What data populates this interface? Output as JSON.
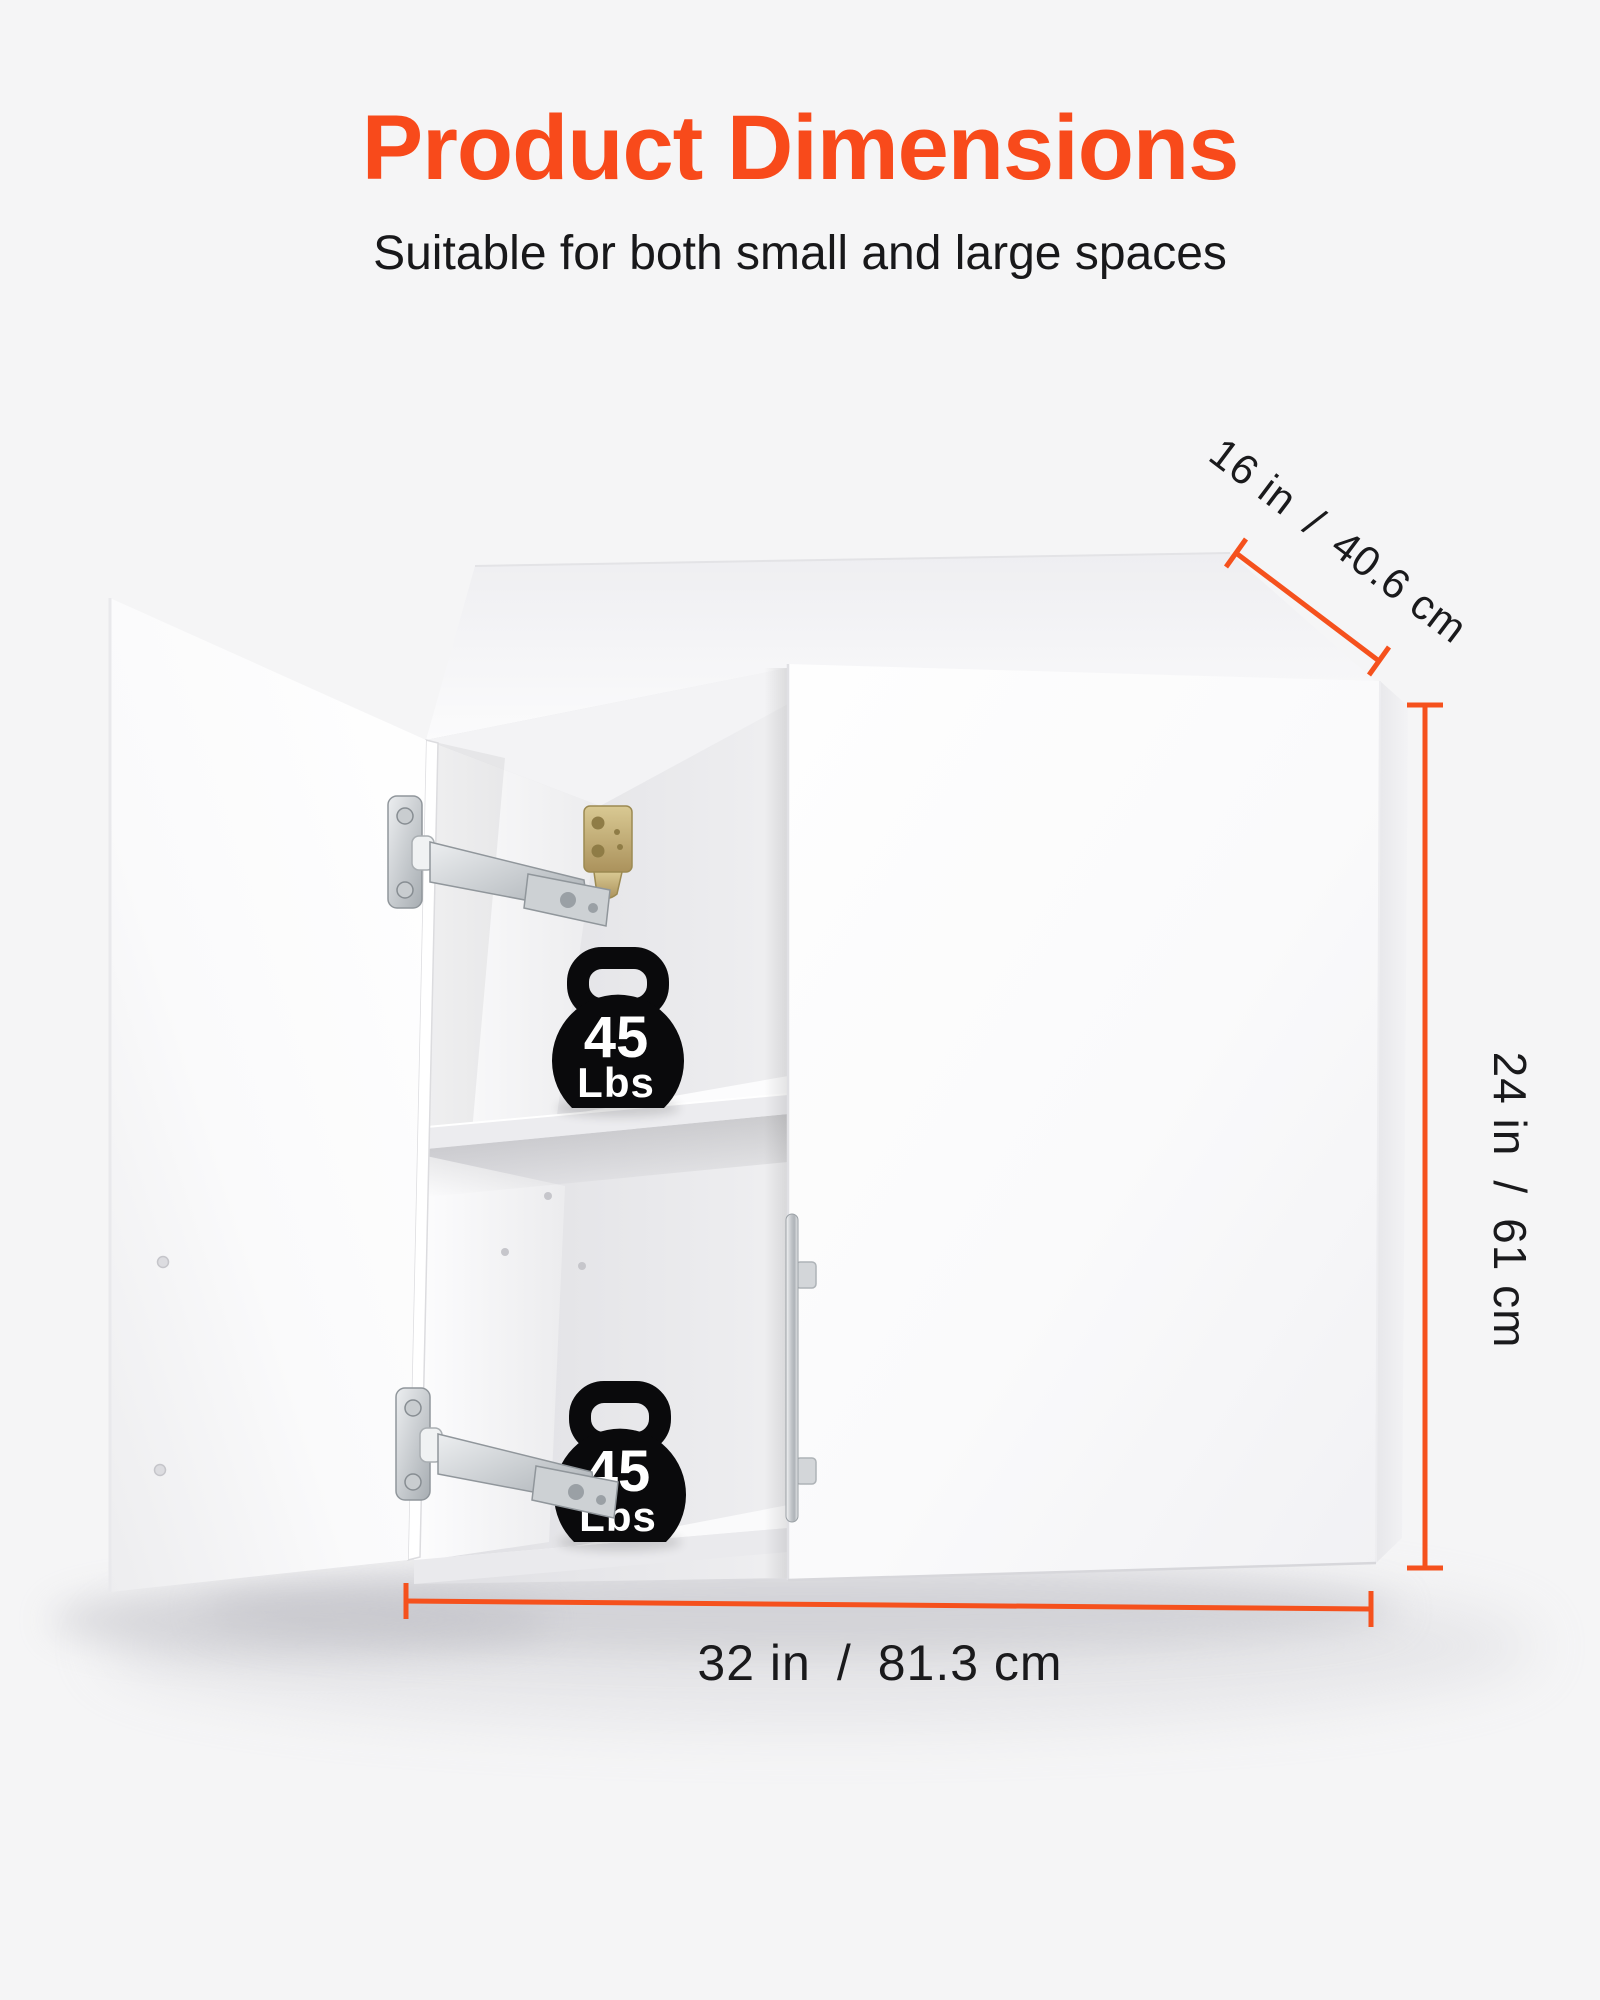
{
  "header": {
    "title": "Product Dimensions",
    "subtitle": "Suitable for both small and large spaces"
  },
  "dimensions": {
    "depth_label": "16 in / 40.6 cm",
    "height_label": "24 in / 61 cm",
    "width_label": "32 in / 81.3 cm"
  },
  "capacity": {
    "top_shelf": {
      "value": "45",
      "unit": "Lbs"
    },
    "bottom_shelf": {
      "value": "45",
      "unit": "Lbs"
    }
  },
  "icons": {
    "weight_capacity": "kettlebell-icon"
  },
  "colors": {
    "accent_orange": "#f5511d",
    "title_orange": "#f84a1b",
    "background": "#f5f5f6",
    "icon_black": "#0a0a0c"
  }
}
